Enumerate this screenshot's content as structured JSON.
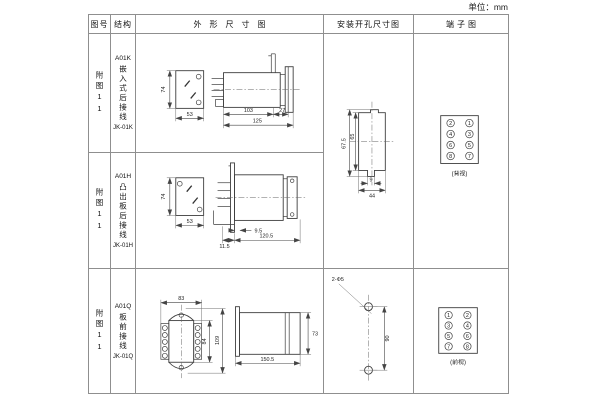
{
  "unit_label": "单位：mm",
  "colors": {
    "line": "#3d3d3d",
    "border": "#8f8f8f",
    "text": "#1a1a1a"
  },
  "table": {
    "headers": [
      "图号",
      "结构",
      "外形尺寸图",
      "安装开孔尺寸图",
      "端子图"
    ],
    "rows": [
      {
        "fig_no": "附图11",
        "model": "A01K",
        "structure": "嵌入式后接线",
        "code": "JK-01K"
      },
      {
        "fig_no": "附图11",
        "model": "A01H",
        "structure": "凸出板后接线",
        "code": "JK-01H"
      },
      {
        "fig_no": "附图11",
        "model": "A01Q",
        "structure": "板前接线",
        "code": "JK-01Q"
      }
    ]
  },
  "dims": {
    "outline1": {
      "height": "74",
      "width": "53",
      "len1": "103",
      "len2": "27",
      "len3": "125"
    },
    "outline2": {
      "height": "74",
      "width": "53",
      "gap": "9.5",
      "bracket": "11.5",
      "length": "120.5"
    },
    "outline3": {
      "width": "83",
      "inner_height": "84",
      "height": "109",
      "side_height": "73",
      "length": "150.5"
    },
    "cutout": {
      "height": "67.5",
      "inner_height": "65",
      "notch": "9",
      "width": "44"
    },
    "holes": {
      "callout": "2-Φ5",
      "pitch": "90"
    }
  },
  "terminals": {
    "rear": {
      "label": "(背视)",
      "left": [
        "2",
        "4",
        "6",
        "8"
      ],
      "right": [
        "1",
        "3",
        "5",
        "7"
      ]
    },
    "front": {
      "label": "(前视)",
      "left": [
        "1",
        "3",
        "5",
        "7"
      ],
      "right": [
        "2",
        "4",
        "6",
        "8"
      ]
    }
  }
}
